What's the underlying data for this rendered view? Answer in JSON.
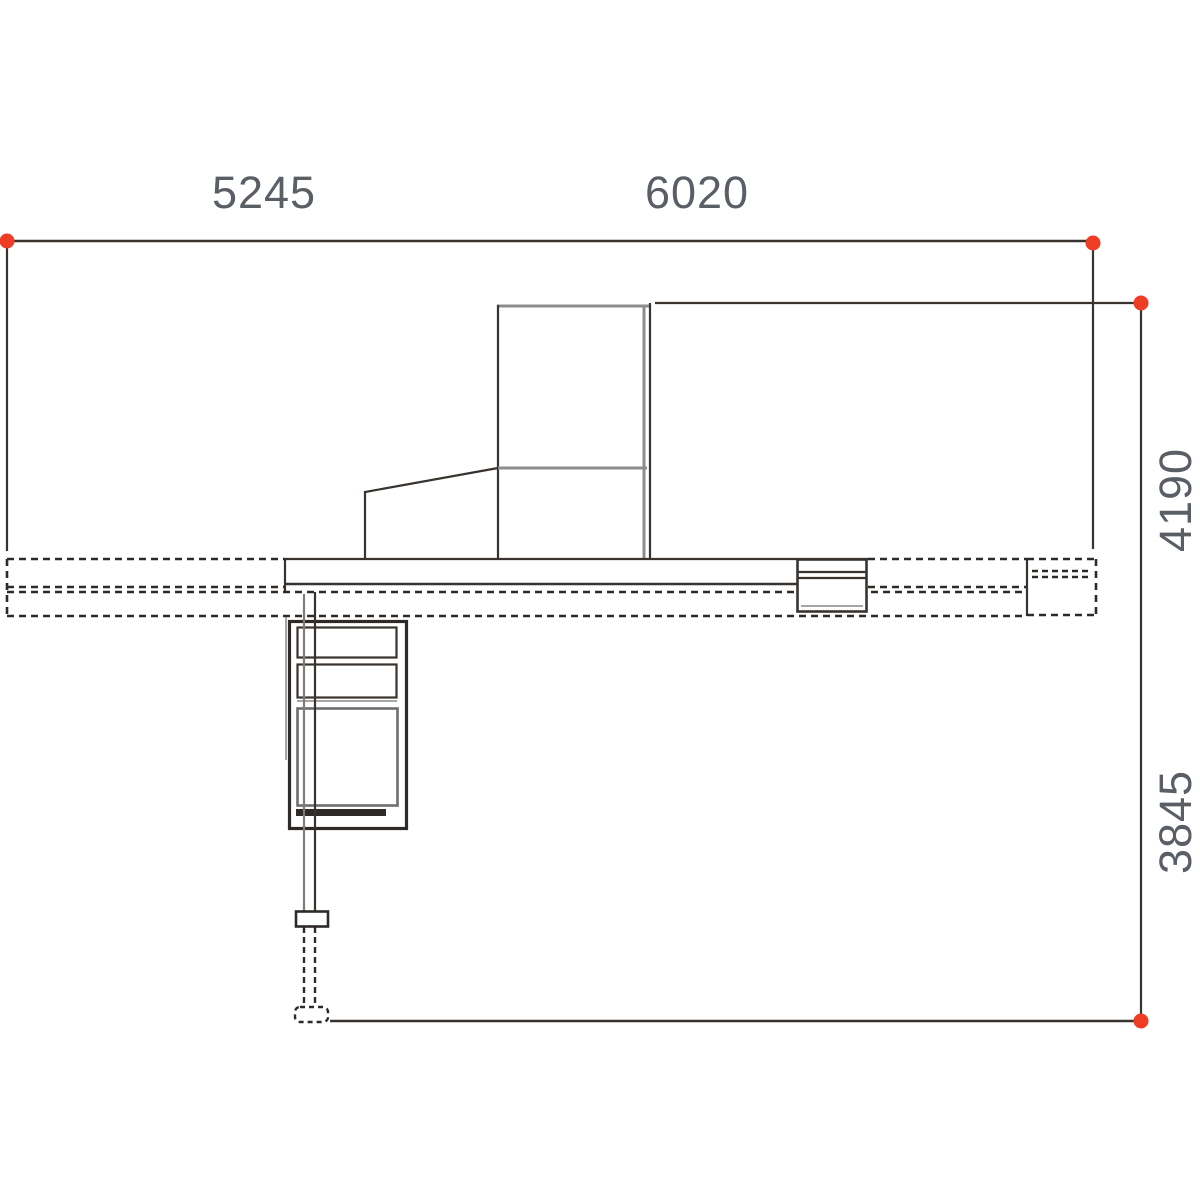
{
  "drawing": {
    "type": "technical-dimension-drawing",
    "view": "machine-side-elevation",
    "labels": {
      "width_left": "5245",
      "width_right": "6020",
      "height_upper": "4190",
      "height_lower": "3845"
    },
    "colors": {
      "marker": "#ee3c25",
      "line_dark": "#38332f",
      "line_gray": "#8d8d8d",
      "text": "#5a5f66",
      "background": "#ffffff"
    }
  }
}
